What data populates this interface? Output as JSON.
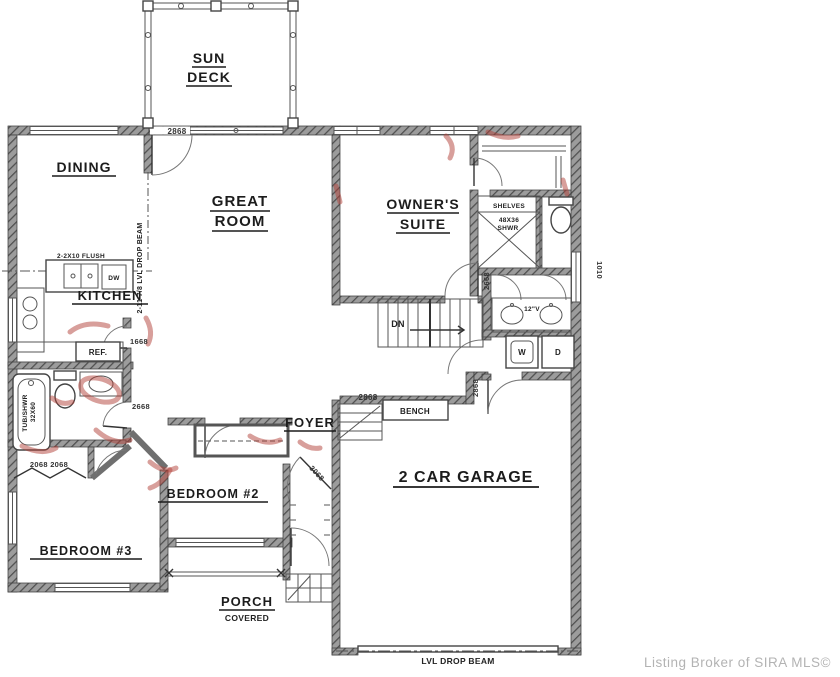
{
  "rooms": {
    "sun1": "SUN",
    "sun2": "DECK",
    "dining": "DINING",
    "great1": "GREAT",
    "great2": "ROOM",
    "owner1": "OWNER'S",
    "owner2": "SUITE",
    "kitchen": "KITCHEN",
    "foyer": "FOYER",
    "bedroom2": "BEDROOM #2",
    "bedroom3": "BEDROOM #3",
    "garage": "2 CAR GARAGE",
    "porch": "PORCH",
    "porch_sub": "COVERED"
  },
  "fixtures": {
    "bench": "BENCH",
    "ref": "REF.",
    "dw": "DW",
    "dn": "DN",
    "washer": "W",
    "dryer": "D",
    "shelves": "SHELVES",
    "shwr_size": "48X36",
    "shwr": "SHWR",
    "tub_line1": "TUB/SHWR",
    "tub_line2": "32X60",
    "vanity": "12\"V"
  },
  "dimensions": {
    "deck_door": "2868",
    "hall_opening": "2868",
    "mud_hall_door": "2868",
    "suite_door": "2668",
    "pantry_door": "1668",
    "bath_door": "2668",
    "bed3_closet": "2068 2068",
    "entry_door": "3068",
    "laundry_window": "1010"
  },
  "annotations": {
    "flush_beam": "2-2X10 FLUSH",
    "drop_beam_vertical": "2-11 7/8 LVL DROP BEAM",
    "garage_beam": "LVL DROP BEAM"
  },
  "watermark": {
    "text": "Listing Broker of SIRA MLS©"
  },
  "colors": {
    "ink": "#1c1c1c",
    "wall_hatch": "#9c9c9c",
    "red_mark": "#b24038",
    "watermark_gray": "#b3b3b3",
    "background": "#ffffff"
  }
}
